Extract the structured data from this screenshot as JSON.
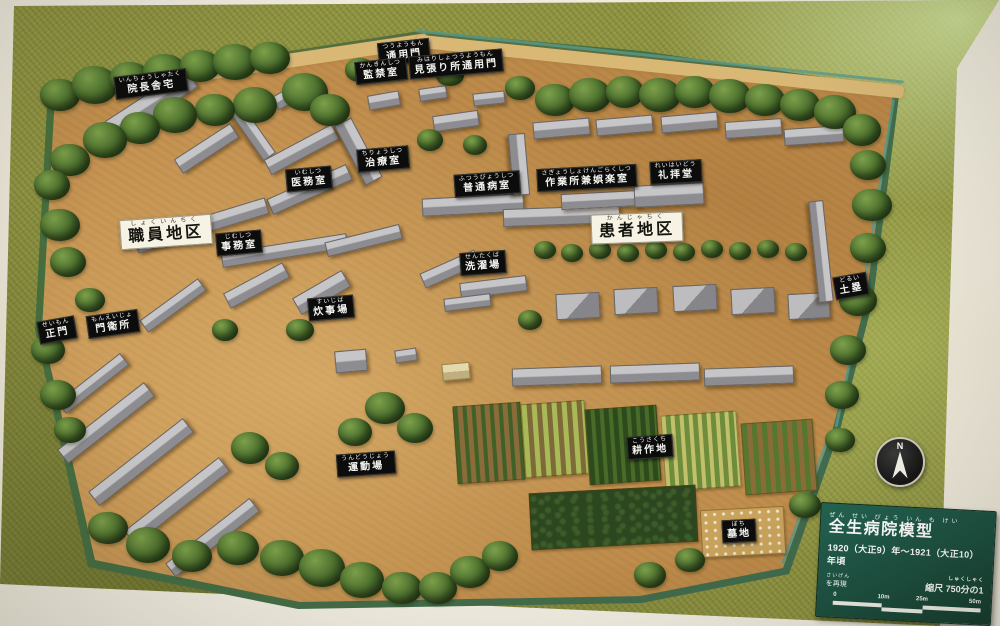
{
  "plaque": {
    "title_kana": "ぜん せい びょう いん も けい",
    "title": "全生病院模型",
    "period_line": "1920（大正9）年～1921（大正10）年頃",
    "recreated_kana": "さいげん",
    "recreated_line": "を再現",
    "scale_kana": "しゅくしゃく",
    "scale_text": "縮尺 750分の1",
    "scale_ticks": [
      "0",
      "10m",
      "25m",
      "50m"
    ]
  },
  "compass": {
    "label": "N"
  },
  "area_labels_note": "white signs mark districts, black signs mark buildings",
  "map_labels": [
    {
      "text": "院長舎宅",
      "kana": "いんちょうしゃたく",
      "style": "black",
      "x": 151,
      "y": 84,
      "rot": -7
    },
    {
      "text": "通用門",
      "kana": "つうようもん",
      "style": "black",
      "x": 404,
      "y": 52,
      "rot": -6
    },
    {
      "text": "見張り所通用門",
      "kana": "みはりしょつうようもん",
      "style": "black",
      "x": 456,
      "y": 64,
      "rot": -5
    },
    {
      "text": "監禁室",
      "kana": "かんきんしつ",
      "style": "black",
      "x": 381,
      "y": 71,
      "rot": -6
    },
    {
      "text": "治療室",
      "kana": "ちりょうしつ",
      "style": "black",
      "x": 383,
      "y": 159,
      "rot": -5
    },
    {
      "text": "医務室",
      "kana": "いむしつ",
      "style": "black",
      "x": 309,
      "y": 179,
      "rot": -5
    },
    {
      "text": "普通病室",
      "kana": "ふつうびょうしつ",
      "style": "black",
      "x": 487,
      "y": 184,
      "rot": -4
    },
    {
      "text": "作業所兼娯楽室",
      "kana": "さぎょうしょけんごらくしつ",
      "style": "black",
      "x": 587,
      "y": 178,
      "rot": -3
    },
    {
      "text": "礼拝堂",
      "kana": "れいはいどう",
      "style": "black",
      "x": 676,
      "y": 172,
      "rot": -3
    },
    {
      "text": "職員地区",
      "kana": "しょくいんちく",
      "style": "white",
      "x": 166,
      "y": 232,
      "rot": -4
    },
    {
      "text": "事務室",
      "kana": "じむしつ",
      "style": "black",
      "x": 239,
      "y": 243,
      "rot": -5
    },
    {
      "text": "患者地区",
      "kana": "かんじゃちく",
      "style": "white",
      "x": 637,
      "y": 228,
      "rot": -2
    },
    {
      "text": "洗濯場",
      "kana": "せんたくば",
      "style": "black",
      "x": 483,
      "y": 263,
      "rot": -4
    },
    {
      "text": "炊事場",
      "kana": "すいじば",
      "style": "black",
      "x": 331,
      "y": 308,
      "rot": -5
    },
    {
      "text": "土塁",
      "kana": "どるい",
      "style": "black",
      "x": 851,
      "y": 286,
      "rot": -10
    },
    {
      "text": "正門",
      "kana": "せいもん",
      "style": "black",
      "x": 57,
      "y": 330,
      "rot": -10
    },
    {
      "text": "門衛所",
      "kana": "もんえいじょ",
      "style": "black",
      "x": 113,
      "y": 324,
      "rot": -8
    },
    {
      "text": "運動場",
      "kana": "うんどうじょう",
      "style": "black",
      "x": 366,
      "y": 464,
      "rot": -4
    },
    {
      "text": "耕作地",
      "kana": "こうさくち",
      "style": "black",
      "x": 650,
      "y": 447,
      "rot": -4
    },
    {
      "text": "墓地",
      "kana": "ぼち",
      "style": "black",
      "x": 739,
      "y": 531,
      "rot": -3
    }
  ],
  "colors": {
    "board_green": "#8f9342",
    "ground_tan": "#c28f4e",
    "tree_green": "#46692a",
    "roof_gray": "#a8a8ab",
    "label_black_bg": "#0c0c0c",
    "label_text": "#f5f5f0",
    "area_label_bg": "#f6f2e4",
    "plaque_bg": "#1a4f40",
    "plaque_text": "#ffffff",
    "compass_bg": "#141414"
  }
}
